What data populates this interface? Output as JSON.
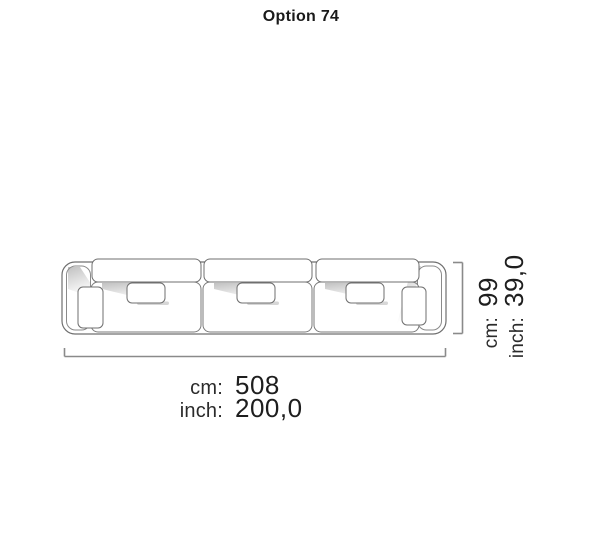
{
  "title": "Option 74",
  "diagram": {
    "drawing": "sofa-3-seater-top-view",
    "outline_color": "#6f6f6f",
    "dimension_line_color": "#8a8a8a",
    "shadow_color": "#c9c9c9"
  },
  "dimensions": {
    "width": {
      "cm_label": "cm:",
      "cm_value": "508",
      "inch_label": "inch:",
      "inch_value": "200,0"
    },
    "height": {
      "cm_label": "cm:",
      "cm_value": "99",
      "inch_label": "inch:",
      "inch_value": "39,0"
    }
  }
}
